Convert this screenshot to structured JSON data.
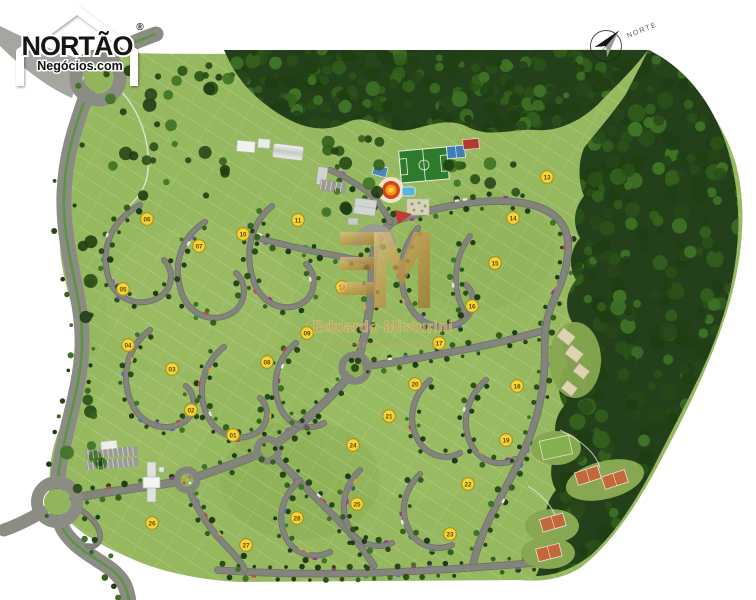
{
  "branding": {
    "name": "NORTÃO",
    "subtitle": "Negócios.com",
    "registered": "®"
  },
  "compass": {
    "label": "NORTE"
  },
  "watermark": {
    "monogram_left": "E",
    "monogram_right": "M",
    "name": "Eduardo Misturini",
    "role": "Corretor de Imóveis"
  },
  "map": {
    "type": "residential-masterplan-site-map",
    "features": [
      "soccer-field",
      "sport-courts",
      "event-arena",
      "swimming-pool",
      "clubhouse",
      "warehouses",
      "entrance-gate",
      "roundabouts",
      "tennis-courts",
      "preserved-forest"
    ],
    "badges": [
      {
        "n": "01",
        "x": 233,
        "y": 435
      },
      {
        "n": "02",
        "x": 191,
        "y": 410
      },
      {
        "n": "03",
        "x": 172,
        "y": 369
      },
      {
        "n": "04",
        "x": 128,
        "y": 345
      },
      {
        "n": "05",
        "x": 123,
        "y": 289
      },
      {
        "n": "06",
        "x": 147,
        "y": 219
      },
      {
        "n": "07",
        "x": 199,
        "y": 246
      },
      {
        "n": "08",
        "x": 267,
        "y": 362
      },
      {
        "n": "09",
        "x": 307,
        "y": 333
      },
      {
        "n": "10",
        "x": 243,
        "y": 234
      },
      {
        "n": "11",
        "x": 298,
        "y": 220
      },
      {
        "n": "12",
        "x": 342,
        "y": 287
      },
      {
        "n": "13",
        "x": 547,
        "y": 177
      },
      {
        "n": "14",
        "x": 513,
        "y": 218
      },
      {
        "n": "15",
        "x": 495,
        "y": 263
      },
      {
        "n": "16",
        "x": 472,
        "y": 306
      },
      {
        "n": "17",
        "x": 439,
        "y": 343
      },
      {
        "n": "18",
        "x": 517,
        "y": 386
      },
      {
        "n": "19",
        "x": 506,
        "y": 440
      },
      {
        "n": "20",
        "x": 415,
        "y": 384
      },
      {
        "n": "21",
        "x": 389,
        "y": 416
      },
      {
        "n": "22",
        "x": 468,
        "y": 484
      },
      {
        "n": "23",
        "x": 450,
        "y": 534
      },
      {
        "n": "24",
        "x": 353,
        "y": 445
      },
      {
        "n": "25",
        "x": 357,
        "y": 504
      },
      {
        "n": "26",
        "x": 152,
        "y": 523
      },
      {
        "n": "27",
        "x": 246,
        "y": 545
      },
      {
        "n": "28",
        "x": 297,
        "y": 518
      }
    ],
    "colors": {
      "lawn": "#96b85e",
      "forest": "#23401a",
      "road": "#83857d",
      "avenue": "#8b8d85",
      "median": "#5d9444",
      "court_clay": "#c2693b",
      "soccer": "#2e7b2d",
      "court_blue": "#3f7fb5",
      "court_red": "#b23a30",
      "arena_ring": "#d0451c",
      "arena_core": "#f59b1e",
      "pool": "#59b4dd",
      "badge_bg": "#f4d538",
      "badge_ring": "#a88f1c",
      "badge_text": "#5f4c05",
      "gold": "#c8a45c"
    }
  }
}
